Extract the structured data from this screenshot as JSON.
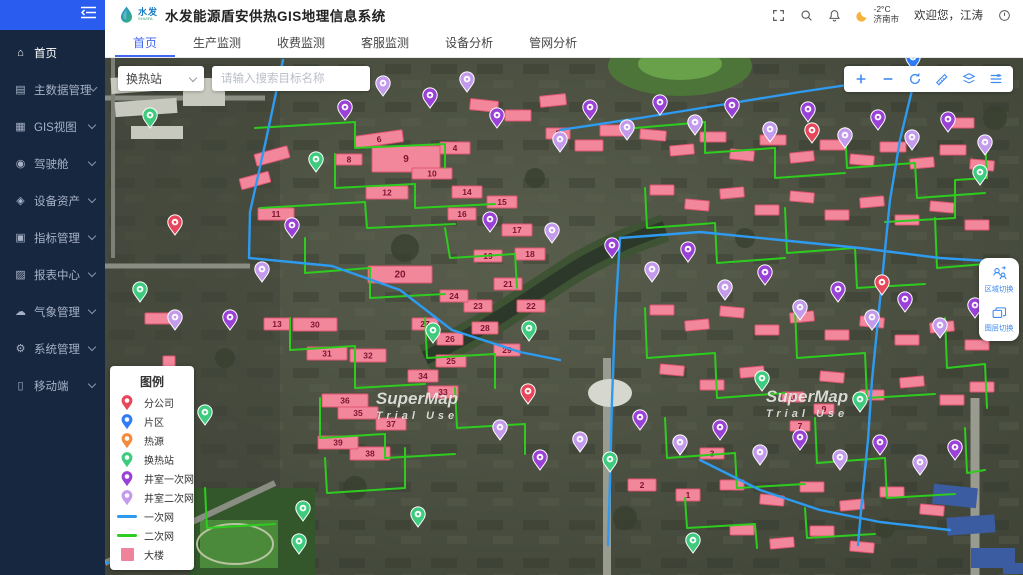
{
  "app": {
    "logo_cn": "水发",
    "logo_en": "SHUIFA",
    "title": "水发能源盾安供热GIS地理信息系统"
  },
  "header": {
    "temperature": "-2°C",
    "city": "济南市",
    "welcome": "欢迎您，江涛"
  },
  "sidebar": {
    "items": [
      {
        "id": "home",
        "label": "首页",
        "icon": "home",
        "active": true,
        "children": false
      },
      {
        "id": "master-data",
        "label": "主数据管理",
        "icon": "db",
        "active": false,
        "children": true
      },
      {
        "id": "gis-view",
        "label": "GIS视图",
        "icon": "gis",
        "active": false,
        "children": true
      },
      {
        "id": "cockpit",
        "label": "驾驶舱",
        "icon": "cockpit",
        "active": false,
        "children": true
      },
      {
        "id": "equipment-assets",
        "label": "设备资产",
        "icon": "asset",
        "active": false,
        "children": true
      },
      {
        "id": "indicator-mgmt",
        "label": "指标管理",
        "icon": "indicator",
        "active": false,
        "children": true
      },
      {
        "id": "report-center",
        "label": "报表中心",
        "icon": "report",
        "active": false,
        "children": true
      },
      {
        "id": "weather-mgmt",
        "label": "气象管理",
        "icon": "weather",
        "active": false,
        "children": true
      },
      {
        "id": "system-mgmt",
        "label": "系统管理",
        "icon": "system",
        "active": false,
        "children": true
      },
      {
        "id": "mobile",
        "label": "移动端",
        "icon": "mobile",
        "active": false,
        "children": true
      }
    ]
  },
  "tabs": [
    {
      "id": "home",
      "label": "首页",
      "active": true
    },
    {
      "id": "production-monitor",
      "label": "生产监测",
      "active": false
    },
    {
      "id": "fee-monitor",
      "label": "收费监测",
      "active": false
    },
    {
      "id": "service-monitor",
      "label": "客服监测",
      "active": false
    },
    {
      "id": "equipment-analysis",
      "label": "设备分析",
      "active": false
    },
    {
      "id": "network-analysis",
      "label": "管网分析",
      "active": false
    }
  ],
  "map": {
    "search": {
      "category": "换热站",
      "placeholder": "请输入搜索目标名称"
    },
    "controls": [
      {
        "id": "zoom-in",
        "icon": "plus"
      },
      {
        "id": "zoom-out",
        "icon": "minus"
      },
      {
        "id": "reset-view",
        "icon": "reset"
      },
      {
        "id": "measure",
        "icon": "measure"
      },
      {
        "id": "layers",
        "icon": "layers"
      },
      {
        "id": "layer-settings",
        "icon": "settings"
      }
    ],
    "side_buttons": [
      {
        "id": "region-switch",
        "label": "区域切换",
        "icon": "region"
      },
      {
        "id": "layer-switch",
        "label": "图层切换",
        "icon": "stack"
      }
    ],
    "watermark": {
      "line1": "SuperMap",
      "line2": "Trial Use",
      "positions": [
        [
          312,
          346
        ],
        [
          702,
          344
        ]
      ]
    },
    "legend": {
      "title": "图例",
      "items": [
        {
          "label": "分公司",
          "type": "pin",
          "color": "#e8465a"
        },
        {
          "label": "片区",
          "type": "pin",
          "color": "#2f7cf6"
        },
        {
          "label": "热源",
          "type": "pin",
          "color": "#f58a3c"
        },
        {
          "label": "换热站",
          "type": "pin",
          "color": "#3fcb7e"
        },
        {
          "label": "井室一次网",
          "type": "pin",
          "color": "#9a41d8"
        },
        {
          "label": "井室二次网",
          "type": "pin",
          "color": "#c39aec"
        },
        {
          "label": "一次网",
          "type": "line",
          "color": "#2e9bf0"
        },
        {
          "label": "二次网",
          "type": "line",
          "color": "#2ecc1f"
        },
        {
          "label": "大楼",
          "type": "square",
          "color": "#f0839b"
        }
      ]
    },
    "colors": {
      "building_fill": "#f2879c",
      "building_stroke": "#e05570",
      "primary_line": "#2e9bf0",
      "secondary_line": "#2ecc1f"
    },
    "pin_colors": {
      "r": "#e8465a",
      "b": "#2f7cf6",
      "o": "#f58a3c",
      "g": "#3fcb7e",
      "p": "#9a41d8",
      "l": "#c39aec"
    },
    "pin_names": {
      "r": "branch-company-pin",
      "b": "district-pin",
      "o": "heat-source-pin",
      "g": "station-pin",
      "p": "well-primary-pin",
      "l": "well-secondary-pin"
    },
    "buildings_labeled": [
      [
        250,
        75,
        48,
        12,
        -8,
        "6"
      ],
      [
        335,
        84,
        30,
        12,
        0,
        "4"
      ],
      [
        267,
        88,
        68,
        26,
        0,
        "9"
      ],
      [
        231,
        96,
        26,
        11,
        0,
        "8"
      ],
      [
        307,
        110,
        40,
        11,
        0,
        "10"
      ],
      [
        261,
        128,
        42,
        13,
        0,
        "12"
      ],
      [
        441,
        70,
        24,
        11,
        0,
        "5"
      ],
      [
        153,
        150,
        36,
        12,
        0,
        "11"
      ],
      [
        347,
        128,
        30,
        12,
        0,
        "14"
      ],
      [
        382,
        138,
        30,
        12,
        0,
        "15"
      ],
      [
        343,
        150,
        28,
        12,
        0,
        "16"
      ],
      [
        397,
        166,
        30,
        12,
        0,
        "17"
      ],
      [
        410,
        190,
        30,
        12,
        0,
        "18"
      ],
      [
        369,
        192,
        28,
        12,
        0,
        "19"
      ],
      [
        263,
        208,
        64,
        17,
        0,
        "20"
      ],
      [
        389,
        220,
        28,
        12,
        0,
        "21"
      ],
      [
        412,
        242,
        28,
        12,
        0,
        "22"
      ],
      [
        359,
        242,
        28,
        12,
        0,
        "23"
      ],
      [
        335,
        232,
        28,
        12,
        0,
        "24"
      ],
      [
        331,
        297,
        30,
        12,
        0,
        "25"
      ],
      [
        332,
        275,
        26,
        12,
        0,
        "26"
      ],
      [
        307,
        260,
        26,
        12,
        0,
        "27"
      ],
      [
        367,
        264,
        26,
        12,
        0,
        "28"
      ],
      [
        389,
        286,
        26,
        12,
        0,
        "29"
      ],
      [
        188,
        260,
        44,
        13,
        0,
        "30"
      ],
      [
        202,
        289,
        40,
        13,
        0,
        "31"
      ],
      [
        245,
        291,
        36,
        13,
        0,
        "32"
      ],
      [
        323,
        328,
        30,
        12,
        0,
        "33"
      ],
      [
        303,
        312,
        30,
        12,
        0,
        "34"
      ],
      [
        233,
        349,
        40,
        12,
        0,
        "35"
      ],
      [
        217,
        336,
        46,
        13,
        0,
        "36"
      ],
      [
        271,
        360,
        30,
        12,
        0,
        "37"
      ],
      [
        245,
        389,
        40,
        13,
        0,
        "38"
      ],
      [
        213,
        378,
        40,
        13,
        0,
        "39"
      ],
      [
        159,
        260,
        26,
        12,
        0,
        "13"
      ],
      [
        523,
        421,
        28,
        12,
        0,
        "2"
      ],
      [
        571,
        431,
        24,
        12,
        0,
        "1"
      ],
      [
        595,
        390,
        24,
        11,
        0,
        "3"
      ],
      [
        677,
        334,
        22,
        10,
        0,
        "10"
      ],
      [
        709,
        346,
        20,
        10,
        0,
        "9"
      ],
      [
        685,
        363,
        20,
        10,
        0,
        "7"
      ]
    ],
    "buildings_small": [
      [
        365,
        42,
        28,
        11,
        6
      ],
      [
        400,
        52,
        26,
        11,
        0
      ],
      [
        435,
        37,
        26,
        11,
        -6
      ],
      [
        470,
        82,
        28,
        11,
        0
      ],
      [
        495,
        67,
        26,
        11,
        0
      ],
      [
        535,
        72,
        26,
        10,
        5
      ],
      [
        565,
        87,
        24,
        10,
        -5
      ],
      [
        595,
        74,
        26,
        10,
        0
      ],
      [
        625,
        92,
        24,
        10,
        6
      ],
      [
        655,
        77,
        26,
        10,
        0
      ],
      [
        685,
        94,
        24,
        10,
        -6
      ],
      [
        715,
        82,
        26,
        10,
        0
      ],
      [
        745,
        97,
        24,
        10,
        5
      ],
      [
        775,
        84,
        26,
        10,
        0
      ],
      [
        805,
        100,
        24,
        10,
        -5
      ],
      [
        835,
        87,
        26,
        10,
        0
      ],
      [
        865,
        102,
        24,
        10,
        5
      ],
      [
        845,
        60,
        24,
        10,
        0
      ],
      [
        545,
        127,
        24,
        10,
        0
      ],
      [
        580,
        142,
        24,
        10,
        5
      ],
      [
        615,
        130,
        24,
        10,
        -5
      ],
      [
        650,
        147,
        24,
        10,
        0
      ],
      [
        685,
        134,
        24,
        10,
        5
      ],
      [
        720,
        152,
        24,
        10,
        0
      ],
      [
        755,
        139,
        24,
        10,
        -5
      ],
      [
        790,
        157,
        24,
        10,
        0
      ],
      [
        825,
        144,
        24,
        10,
        5
      ],
      [
        860,
        162,
        24,
        10,
        0
      ],
      [
        545,
        247,
        24,
        10,
        0
      ],
      [
        580,
        262,
        24,
        10,
        -5
      ],
      [
        615,
        249,
        24,
        10,
        5
      ],
      [
        650,
        267,
        24,
        10,
        0
      ],
      [
        685,
        254,
        24,
        10,
        -5
      ],
      [
        720,
        272,
        24,
        10,
        0
      ],
      [
        755,
        259,
        24,
        10,
        5
      ],
      [
        790,
        277,
        24,
        10,
        0
      ],
      [
        825,
        264,
        24,
        10,
        -5
      ],
      [
        860,
        282,
        24,
        10,
        0
      ],
      [
        555,
        307,
        24,
        10,
        5
      ],
      [
        595,
        322,
        24,
        10,
        0
      ],
      [
        635,
        309,
        24,
        10,
        -5
      ],
      [
        715,
        314,
        24,
        10,
        5
      ],
      [
        755,
        332,
        24,
        10,
        0
      ],
      [
        795,
        319,
        24,
        10,
        -5
      ],
      [
        835,
        337,
        24,
        10,
        0
      ],
      [
        865,
        324,
        24,
        10,
        0
      ],
      [
        615,
        422,
        24,
        10,
        0
      ],
      [
        655,
        437,
        24,
        10,
        5
      ],
      [
        695,
        424,
        24,
        10,
        0
      ],
      [
        735,
        442,
        24,
        10,
        -5
      ],
      [
        775,
        429,
        24,
        10,
        0
      ],
      [
        815,
        447,
        24,
        10,
        5
      ],
      [
        625,
        467,
        24,
        10,
        0
      ],
      [
        665,
        480,
        24,
        10,
        -5
      ],
      [
        705,
        468,
        24,
        10,
        0
      ],
      [
        745,
        484,
        24,
        10,
        5
      ],
      [
        150,
        92,
        34,
        12,
        -15
      ],
      [
        135,
        117,
        30,
        11,
        -15
      ],
      [
        40,
        255,
        26,
        11,
        0
      ],
      [
        58,
        298,
        12,
        26,
        0
      ]
    ],
    "pins": {
      "r": [
        [
          70,
          177
        ],
        [
          707,
          85
        ],
        [
          777,
          237
        ],
        [
          423,
          346
        ]
      ],
      "b": [
        [
          808,
          12
        ]
      ],
      "g": [
        [
          45,
          70
        ],
        [
          211,
          114
        ],
        [
          328,
          285
        ],
        [
          424,
          283
        ],
        [
          505,
          414
        ],
        [
          588,
          495
        ],
        [
          657,
          333
        ],
        [
          755,
          354
        ],
        [
          313,
          469
        ],
        [
          198,
          463
        ],
        [
          194,
          496
        ],
        [
          35,
          244
        ],
        [
          875,
          127
        ],
        [
          100,
          367
        ]
      ],
      "p": [
        [
          240,
          62
        ],
        [
          325,
          50
        ],
        [
          392,
          70
        ],
        [
          485,
          62
        ],
        [
          555,
          57
        ],
        [
          627,
          60
        ],
        [
          703,
          64
        ],
        [
          773,
          72
        ],
        [
          843,
          74
        ],
        [
          385,
          174
        ],
        [
          507,
          200
        ],
        [
          583,
          204
        ],
        [
          660,
          227
        ],
        [
          733,
          244
        ],
        [
          800,
          254
        ],
        [
          870,
          260
        ],
        [
          435,
          412
        ],
        [
          535,
          372
        ],
        [
          615,
          382
        ],
        [
          695,
          392
        ],
        [
          775,
          397
        ],
        [
          850,
          402
        ],
        [
          187,
          180
        ],
        [
          125,
          272
        ],
        [
          23,
          490
        ]
      ],
      "l": [
        [
          278,
          38
        ],
        [
          362,
          34
        ],
        [
          455,
          94
        ],
        [
          522,
          82
        ],
        [
          590,
          77
        ],
        [
          665,
          84
        ],
        [
          740,
          90
        ],
        [
          807,
          92
        ],
        [
          880,
          97
        ],
        [
          447,
          185
        ],
        [
          547,
          224
        ],
        [
          620,
          242
        ],
        [
          695,
          262
        ],
        [
          767,
          272
        ],
        [
          835,
          280
        ],
        [
          395,
          382
        ],
        [
          475,
          394
        ],
        [
          575,
          397
        ],
        [
          655,
          407
        ],
        [
          735,
          412
        ],
        [
          815,
          417
        ],
        [
          157,
          224
        ],
        [
          70,
          272
        ]
      ]
    },
    "primary_paths": [
      "M178,2 L161,82 L145,154 L144,200 L227,208 L295,232 L347,272 L415,294 L455,302",
      "M455,72 L535,60 L615,47 L695,34 L803,18 L808,28 L795,82 L785,142 L779,202 L773,262 L767,322 L763,382 L757,442 L753,487",
      "M515,180 L595,174 L675,182 L755,190 L835,200 L900,204",
      "M515,180 L510,262 L507,342 L505,422 L503,487",
      "M595,402 L655,432 L715,452 L775,464 L845,472",
      "M0,505 L45,500"
    ],
    "secondary_paths": [
      "M150,70 L250,64 L250,90 L340,86 L340,110",
      "M230,96 L230,130 L310,126 L310,150 L390,146",
      "M155,150 L260,144 L262,170 L350,166",
      "M200,180 L200,215 L265,210 L265,240 L340,236",
      "M340,170 L345,200 L410,196 L412,230",
      "M185,260 L185,292 L250,288 L250,330 L320,326",
      "M320,260 L322,300 L390,296 L390,330",
      "M215,340 L215,380 L280,376 L280,400 L350,396",
      "M350,330 L352,370 L420,366 L420,396",
      "M220,400 L222,435 L300,430 L300,390",
      "M530,70 L600,64 L600,95 L670,90 L670,120 L740,115",
      "M740,70 L742,110 L810,105 L812,140 L880,135",
      "M880,80 L882,120 L850,122 L850,160 L780,164",
      "M540,130 L542,170 L610,165 L612,205 L680,200",
      "M680,150 L682,195 L750,190 L752,230 L820,226",
      "M830,160 L832,210 L880,206 L882,250",
      "M540,250 L542,300 L610,295 L612,340 L680,335",
      "M690,250 L692,300 L760,295 L762,340 L830,336",
      "M840,260 L842,310 L880,306 L882,350",
      "M560,360 L562,400 L630,395 L632,430 L700,426",
      "M710,360 L712,405 L780,400 L782,440 L850,436",
      "M860,370 L862,415 L880,412",
      "M580,440 L582,470 L650,466 L652,490",
      "M700,450 L702,480 L770,476",
      "M100,430 L102,470 L170,466"
    ]
  }
}
